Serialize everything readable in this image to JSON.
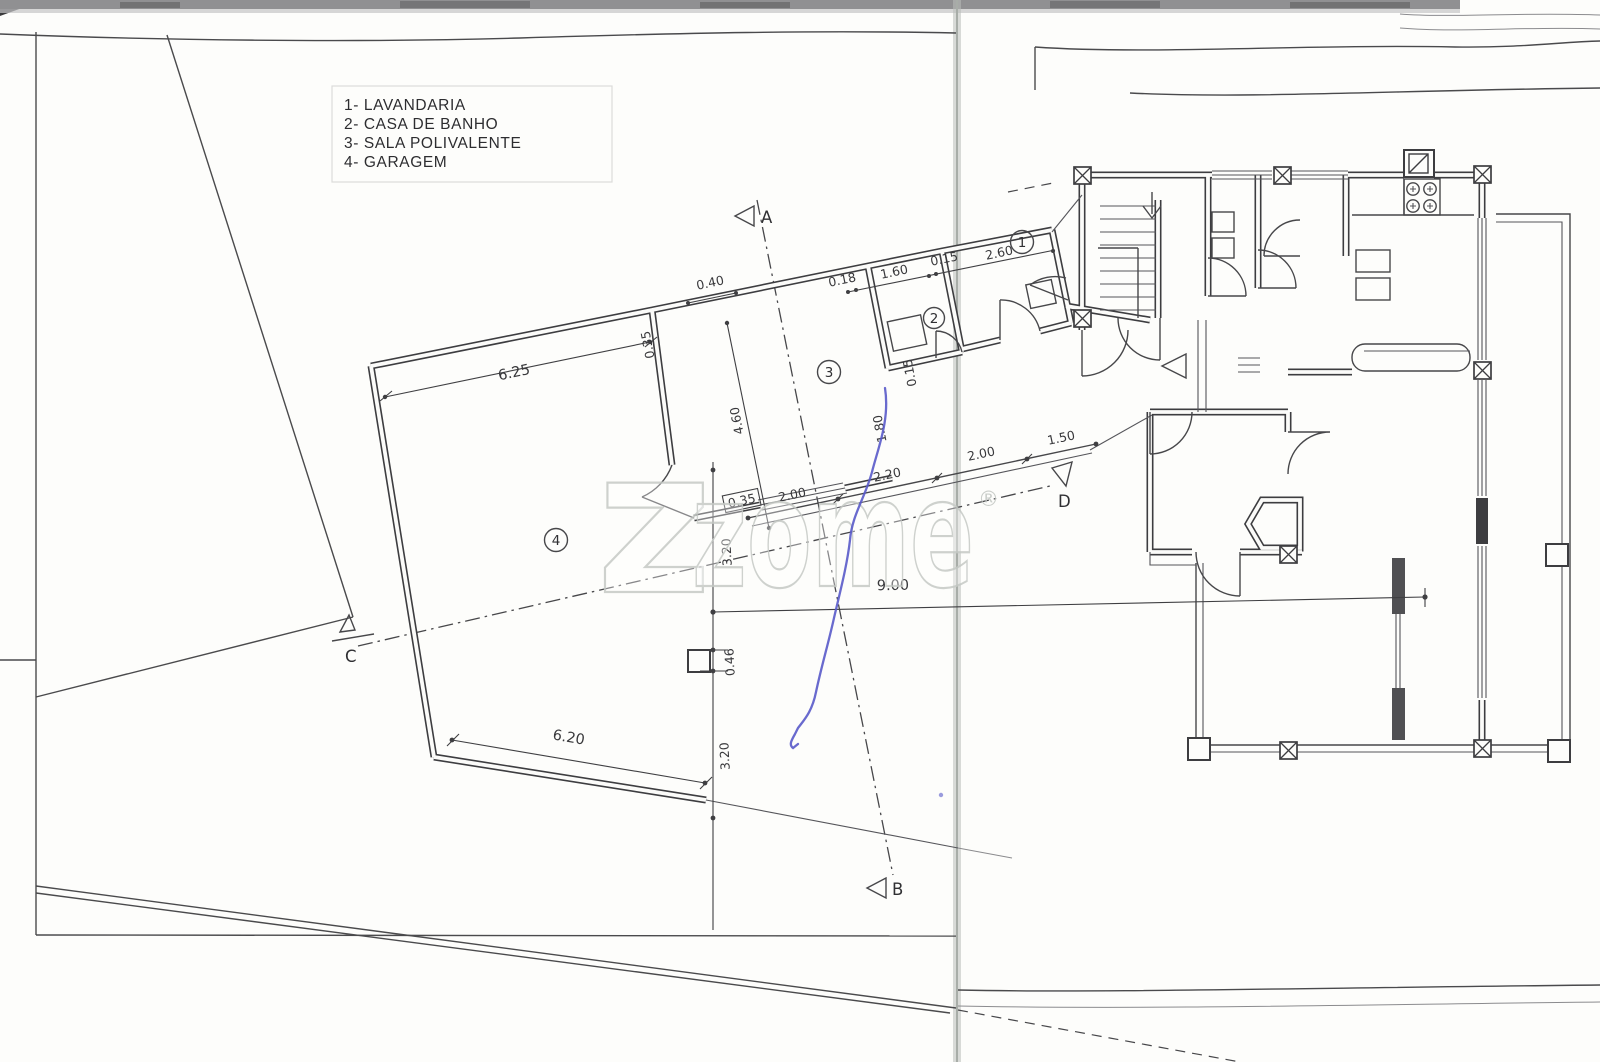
{
  "legend": {
    "items": [
      "1- LAVANDARIA",
      "2- CASA DE BANHO",
      "3- SALA POLIVALENTE",
      "4- GARAGEM"
    ]
  },
  "rooms": [
    "1",
    "2",
    "3",
    "4"
  ],
  "sections": {
    "a": "A",
    "b": "B",
    "c": "C",
    "d": "D"
  },
  "dims": {
    "door_top": "0.40",
    "garage_width": "6.25",
    "wall_a": "0.35",
    "room3_depth": "4.60",
    "chain_a": "0.18",
    "chain_b": "1.60",
    "chain_c": "0.15",
    "room1_width": "2.60",
    "wall_b": "0.15",
    "room2_depth": "1.80",
    "walk_box": "0.35",
    "walk_a": "2.00",
    "walk_b": "2.20",
    "walk_c": "2.00",
    "walk_d": "1.50",
    "yard_width": "9.00",
    "yard_a": "3.20",
    "pillar": "0.46",
    "yard_b": "3.20",
    "garage_bottom": "6.20"
  },
  "watermark": {
    "logo_z": "z",
    "text": "zome",
    "registered": "®"
  },
  "colors": {
    "ink": "#3d3d40",
    "pen_blue": "#595ac9",
    "fold_gray": "#b9beb9",
    "watermark_gray": "#c6cac6"
  }
}
